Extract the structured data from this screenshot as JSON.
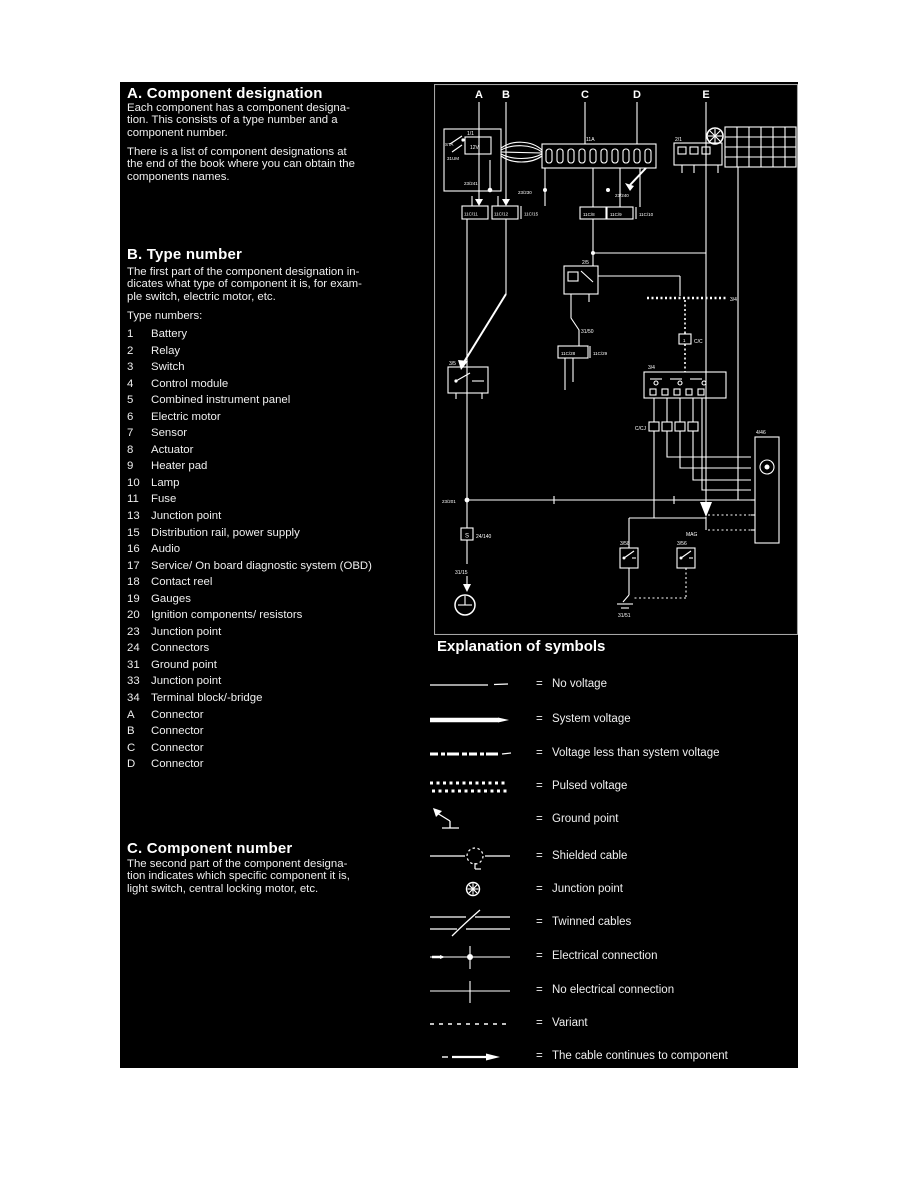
{
  "left_column": {
    "section_a": {
      "title": "A. Component designation",
      "para1_lines": [
        "Each component has a component designa-",
        "tion. This consists of a type number and a",
        "component number."
      ],
      "para2_lines": [
        "There is a list of component designations at",
        "the end of the book where you can obtain the",
        "components names."
      ]
    },
    "section_b": {
      "title": "B. Type number",
      "para_lines": [
        "The first part of the component designation in-",
        "dicates what type of component it is, for exam-",
        "ple switch, electric motor, etc."
      ],
      "list_intro": "Type numbers:"
    },
    "type_numbers": [
      {
        "num": "1",
        "label": "Battery"
      },
      {
        "num": "2",
        "label": "Relay"
      },
      {
        "num": "3",
        "label": "Switch"
      },
      {
        "num": "4",
        "label": "Control module"
      },
      {
        "num": "5",
        "label": "Combined instrument panel"
      },
      {
        "num": "6",
        "label": "Electric motor"
      },
      {
        "num": "7",
        "label": "Sensor"
      },
      {
        "num": "8",
        "label": "Actuator"
      },
      {
        "num": "9",
        "label": "Heater pad"
      },
      {
        "num": "10",
        "label": "Lamp"
      },
      {
        "num": "11",
        "label": "Fuse"
      },
      {
        "num": "13",
        "label": "Junction point"
      },
      {
        "num": "15",
        "label": "Distribution rail, power supply"
      },
      {
        "num": "16",
        "label": "Audio"
      },
      {
        "num": "17",
        "label": "Service/ On board diagnostic system (OBD)"
      },
      {
        "num": "18",
        "label": "Contact reel"
      },
      {
        "num": "19",
        "label": "Gauges"
      },
      {
        "num": "20",
        "label": "Ignition components/ resistors"
      },
      {
        "num": "23",
        "label": "Junction point"
      },
      {
        "num": "24",
        "label": "Connectors"
      },
      {
        "num": "31",
        "label": "Ground point"
      },
      {
        "num": "33",
        "label": "Junction point"
      },
      {
        "num": "34",
        "label": "Terminal block/-bridge"
      },
      {
        "num": "A",
        "label": "Connector"
      },
      {
        "num": "B",
        "label": "Connector"
      },
      {
        "num": "C",
        "label": "Connector"
      },
      {
        "num": "D",
        "label": "Connector"
      }
    ],
    "section_c": {
      "title": "C. Component number",
      "para_lines": [
        "The second part of the component designa-",
        "tion indicates which specific component it is,",
        "light switch, central locking motor, etc."
      ]
    }
  },
  "diagram": {
    "column_labels": [
      "A",
      "B",
      "C",
      "D",
      "E"
    ],
    "labels": {
      "sta": "STA",
      "um": "31UM",
      "battery": "1/1",
      "batt12v": "12V",
      "fusebox": "11A",
      "j241": "23/241",
      "j230": "23/230",
      "j240": "23/240",
      "c11": "11C/11",
      "c12": "11C/12",
      "c15": "11C/15",
      "c8": "11C/8",
      "c9": "11C/9",
      "c10": "11C/10",
      "comp21": "2/1",
      "relay": "2/5",
      "g50": "31/50",
      "c28": "11C/28",
      "c29": "11C/29",
      "rail34": "3/4",
      "cc": "C/C",
      "cc_num": "1",
      "sw35": "3/5",
      "comp34": "3/4",
      "ccj": "C/CJ",
      "comp446": "4/46",
      "j201": "23/201",
      "s": "S",
      "t140": "24/140",
      "g15": "31/15",
      "sw358": "3/58",
      "sw356": "3/56",
      "g51": "31/51",
      "mag": "MAG"
    }
  },
  "symbols": {
    "title": "Explanation of symbols",
    "equals_sign": "=",
    "rows": [
      {
        "symbol": "no-voltage-line",
        "label": "No voltage"
      },
      {
        "symbol": "system-voltage-line",
        "label": "System voltage"
      },
      {
        "symbol": "less-than-system-voltage-line",
        "label": "Voltage less than system voltage"
      },
      {
        "symbol": "pulsed-voltage-line",
        "label": "Pulsed voltage"
      },
      {
        "symbol": "ground-point-symbol",
        "label": "Ground point"
      },
      {
        "symbol": "shielded-cable-symbol",
        "label": "Shielded cable"
      },
      {
        "symbol": "junction-point-symbol",
        "label": "Junction point"
      },
      {
        "symbol": "twinned-cables-symbol",
        "label": "Twinned cables"
      },
      {
        "symbol": "electrical-connection-symbol",
        "label": "Electrical connection"
      },
      {
        "symbol": "no-electrical-connection-symbol",
        "label": "No electrical connection"
      },
      {
        "symbol": "variant-line",
        "label": "Variant"
      },
      {
        "symbol": "cable-continues-arrow",
        "label": "The cable continues to component"
      }
    ]
  }
}
